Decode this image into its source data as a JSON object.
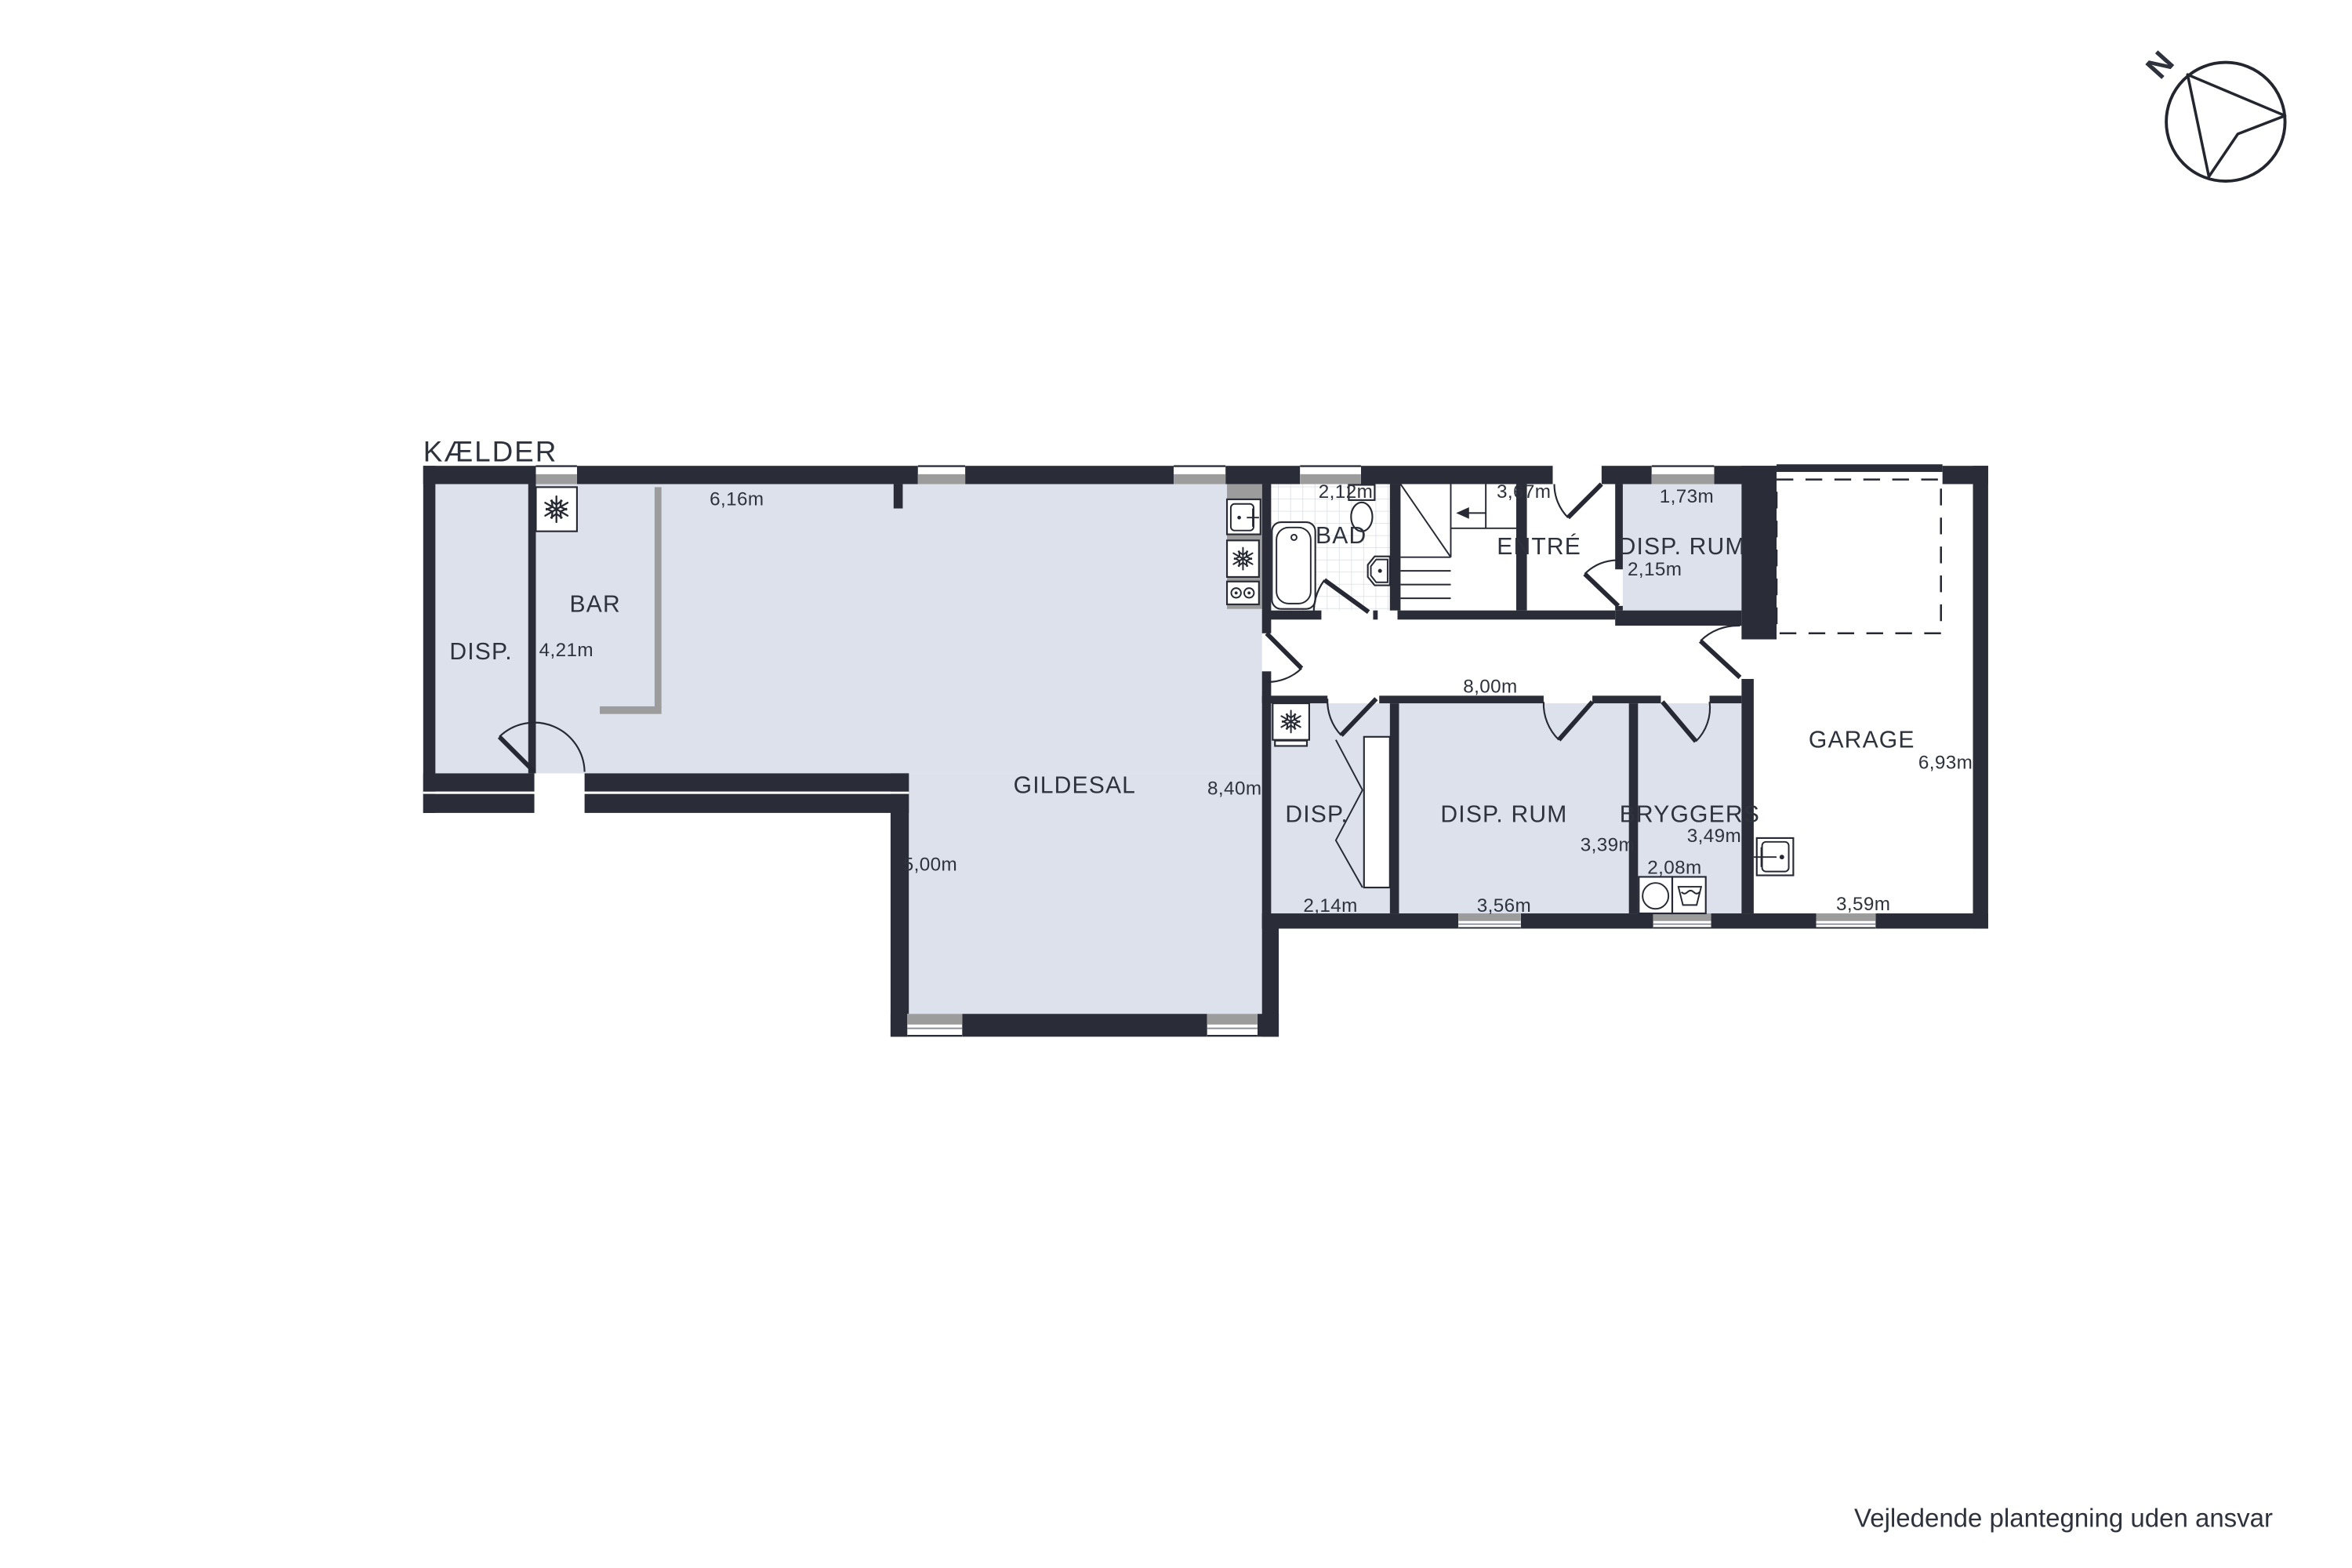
{
  "title": "KÆLDER",
  "disclaimer": "Vejledende plantegning uden ansvar",
  "compass": {
    "north_label": "N"
  },
  "colors": {
    "wall": "#2a2d37",
    "room_fill": "#dce1ec",
    "accent_gray": "#9c9c9c",
    "text": "#2e323c"
  },
  "rooms": {
    "disp_left": "DISP.",
    "bar": "BAR",
    "gildesal": "GILDESAL",
    "bad": "BAD",
    "entre": "ENTRÉ",
    "disp_rum_top": "DISP. RUM",
    "garage": "GARAGE",
    "disp_mid": "DISP.",
    "disp_rum_mid": "DISP. RUM",
    "bryggers": "BRYGGERS"
  },
  "dims": {
    "d616": "6,16m",
    "d421": "4,21m",
    "d212": "2,12m",
    "d367": "3,67m",
    "d173": "1,73m",
    "d215": "2,15m",
    "d800": "8,00m",
    "d840": "8,40m",
    "d500": "5,00m",
    "d214": "2,14m",
    "d356": "3,56m",
    "d339": "3,39m",
    "d349": "3,49m",
    "d208": "2,08m",
    "d693": "6,93m",
    "d359": "3,59m"
  }
}
